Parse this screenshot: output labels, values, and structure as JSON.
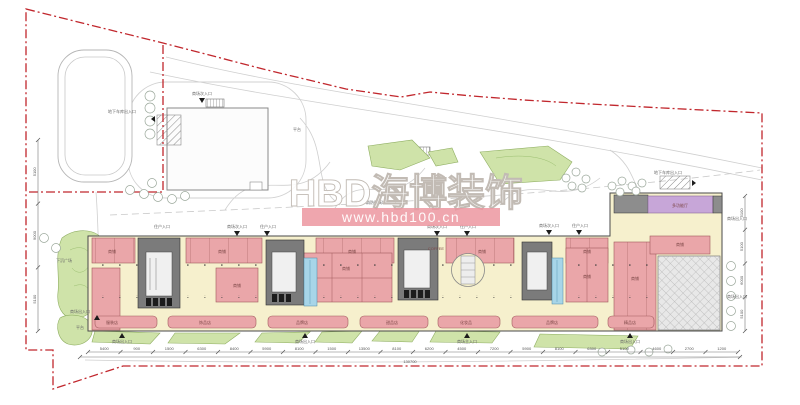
{
  "watermark": {
    "brand": "HBD海博装饰",
    "url": "www.hbd100.cn"
  },
  "labels": {
    "garage_entrance": "地下车库出入口",
    "mall_entrance": "商场出入口",
    "mall_main_entrance": "商场主入口",
    "mall_side_entrance": "商场次入口",
    "resident_entrance": "住户入口",
    "sunken_plaza": "下沉广场",
    "platform": "平台",
    "fire_access": "消防登高场地",
    "shop": "商铺",
    "brand_shop": "品牌店",
    "coffee": "COFFEE",
    "multifunction": "多功能厅",
    "clothes": "服装店",
    "accessories": "饰品店",
    "dessert": "甜品店",
    "cosmetics": "化妆品",
    "boutique": "精品店"
  },
  "colors": {
    "boundary_red": "#c1272d",
    "shop_pink": "#eaa6a9",
    "corridor_cream": "#f6f0cd",
    "landscape_green": "#cfe3a9",
    "escalator_blue": "#a7d5e8",
    "feature_purple": "#c7a6d8",
    "watermark_band": "#ec96a0"
  },
  "dimensions": {
    "bottom": [
      "5400",
      "900",
      "1500",
      "6300",
      "8400",
      "5900",
      "8100",
      "1500",
      "13500",
      "8100",
      "6200",
      "4500",
      "7200",
      "5900",
      "8100",
      "6300",
      "5100",
      "4600",
      "2700",
      "1200"
    ],
    "bottom_total": "130700",
    "left": [
      "5100",
      "9000",
      "5100"
    ],
    "right": [
      "5100",
      "5100",
      "6000",
      "5100"
    ]
  }
}
